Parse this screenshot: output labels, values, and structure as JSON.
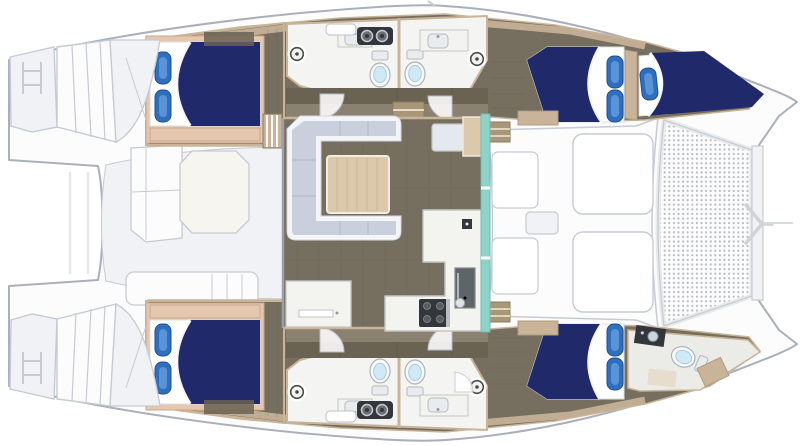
{
  "title": "Catamaran yacht floor plan (overhead view, bow to the right)",
  "palette": {
    "white": "#ffffff",
    "deck-fill": "#fcfcfd",
    "deck-line": "#aab0ba",
    "ghost-fill": "#f1f2f5",
    "ghost-line": "#c6cad2",
    "floor-taupe": "#766e5e",
    "floor-light": "#8a8171",
    "plank-line": "#5e574a",
    "cabinet-dark": "#6a6253",
    "wall-tan": "#c9b499",
    "bed-frame-tan": "#e4c7ae",
    "bed-navy": "#20296a",
    "pillow-blue": "#2f6fc0",
    "pillow-light": "#6ba0dd",
    "sofa-lavender": "#c9cfdd",
    "sofa-trim": "#f4f5f8",
    "wood-light": "#dcc9ab",
    "wood-line": "#c1ab89",
    "counter-white": "#f3f3f0",
    "counter-line": "#c6c6c3",
    "appliance-dark": "#33363b",
    "steel-gray": "#b9bec6",
    "glass-teal": "#8fd2c7",
    "toilet-blue": "#cfe9f5",
    "tramp-dot": "#b7bac0",
    "drain-ring": "#4a4a48"
  },
  "vessel": {
    "type": "sailing-catamaran-floorplan",
    "view": "top-down",
    "bow_direction": "right",
    "double_berths": 4,
    "crew_berths": 1,
    "toilets": 5
  },
  "regions": {
    "salon": "U-sofa with dining table, sideboard, nav desk and seat",
    "galley": "L-counter with 4-burner stove, sink, fridge",
    "glass_door": "teal sliding glass wall forward of salon",
    "port_hull": "aft double cabin, two heads with toilets and sinks, forward double cabin, bow crew berth",
    "starboard_hull": "aft double cabin, two heads with toilets and sinks, forward double cabin, bow crew head",
    "aft_cockpit": "ghosted table and bench seating between transoms",
    "foredeck": "two sun pads, two seats, small table",
    "trampoline": "mesh net between bows with crossbeam and seagull striker",
    "transoms": "stepped swim platforms with boarding ladders"
  }
}
